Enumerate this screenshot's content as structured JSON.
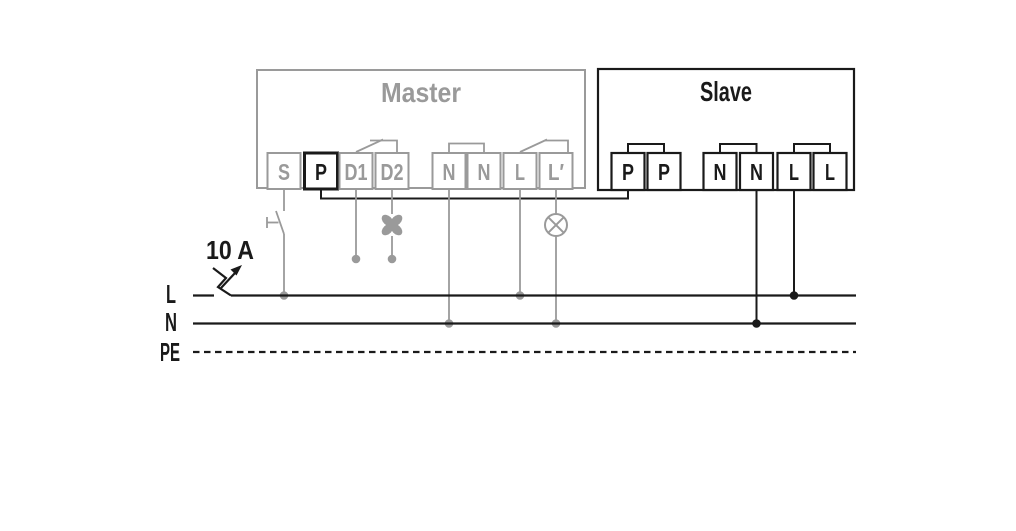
{
  "master": {
    "title": "Master",
    "terminals": [
      "S",
      "P",
      "D1",
      "D2",
      "N",
      "N",
      "L",
      "L′"
    ]
  },
  "slave": {
    "title": "Slave",
    "terminals": [
      "P",
      "P",
      "N",
      "N",
      "L",
      "L"
    ]
  },
  "supply": {
    "breaker_rating": "10 A",
    "rail_labels": {
      "line": "L",
      "neutral": "N",
      "earth": "PE"
    }
  },
  "icons": {
    "fan": "✣",
    "lamp": "⊗",
    "circuit_breaker": "zigzag-blade-with-arrow",
    "push_button": "⊢ actuator with blade contact",
    "bridge_link": "⊓"
  },
  "colors": {
    "inactive_gray": "#9a9a9a",
    "active_black": "#1a1a1a",
    "background": "#ffffff"
  }
}
